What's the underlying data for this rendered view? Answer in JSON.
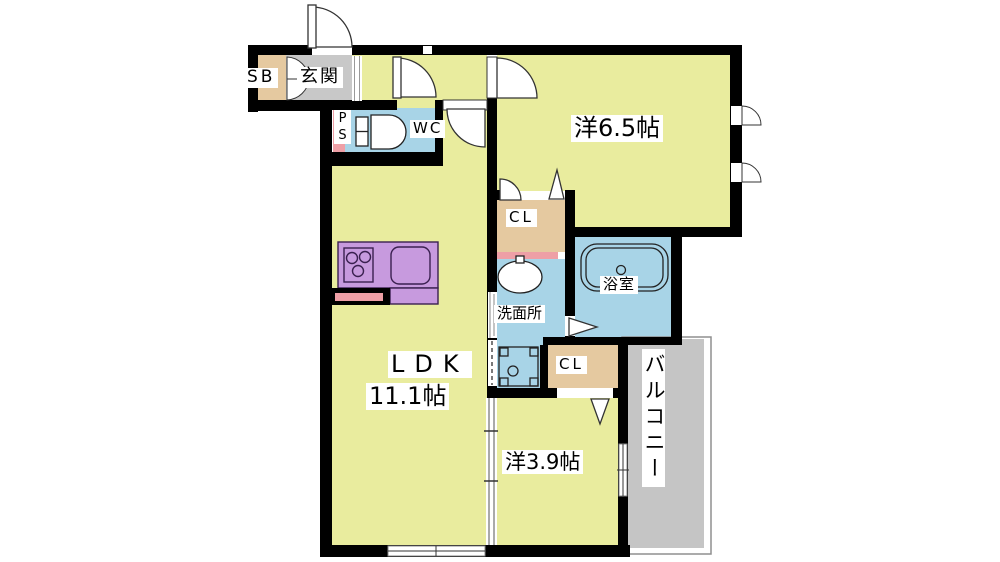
{
  "colors": {
    "wall": "#000000",
    "room_yellow": "#e9ec9e",
    "entrance_gray": "#c8c8c8",
    "closet_tan": "#e5c9a0",
    "water_blue": "#a8d4e7",
    "kitchen_purple": "#c79ade",
    "pipe_pink": "#ee9fa6",
    "balcony_gray": "#c5c5c5",
    "door_outline": "#333333"
  },
  "labels": {
    "shoe_box": "SB",
    "entrance": "玄関",
    "pipe_space_p": "P",
    "pipe_space_s": "S",
    "toilet": "WC",
    "western_6_5": "洋6.5帖",
    "closet_upper": "CL",
    "bathroom": "浴室",
    "washroom": "洗面所",
    "closet_lower": "CL",
    "ldk_name": "LDK",
    "ldk_size": "11.1帖",
    "western_3_9": "洋3.9帖",
    "balcony": "バルコニー"
  }
}
